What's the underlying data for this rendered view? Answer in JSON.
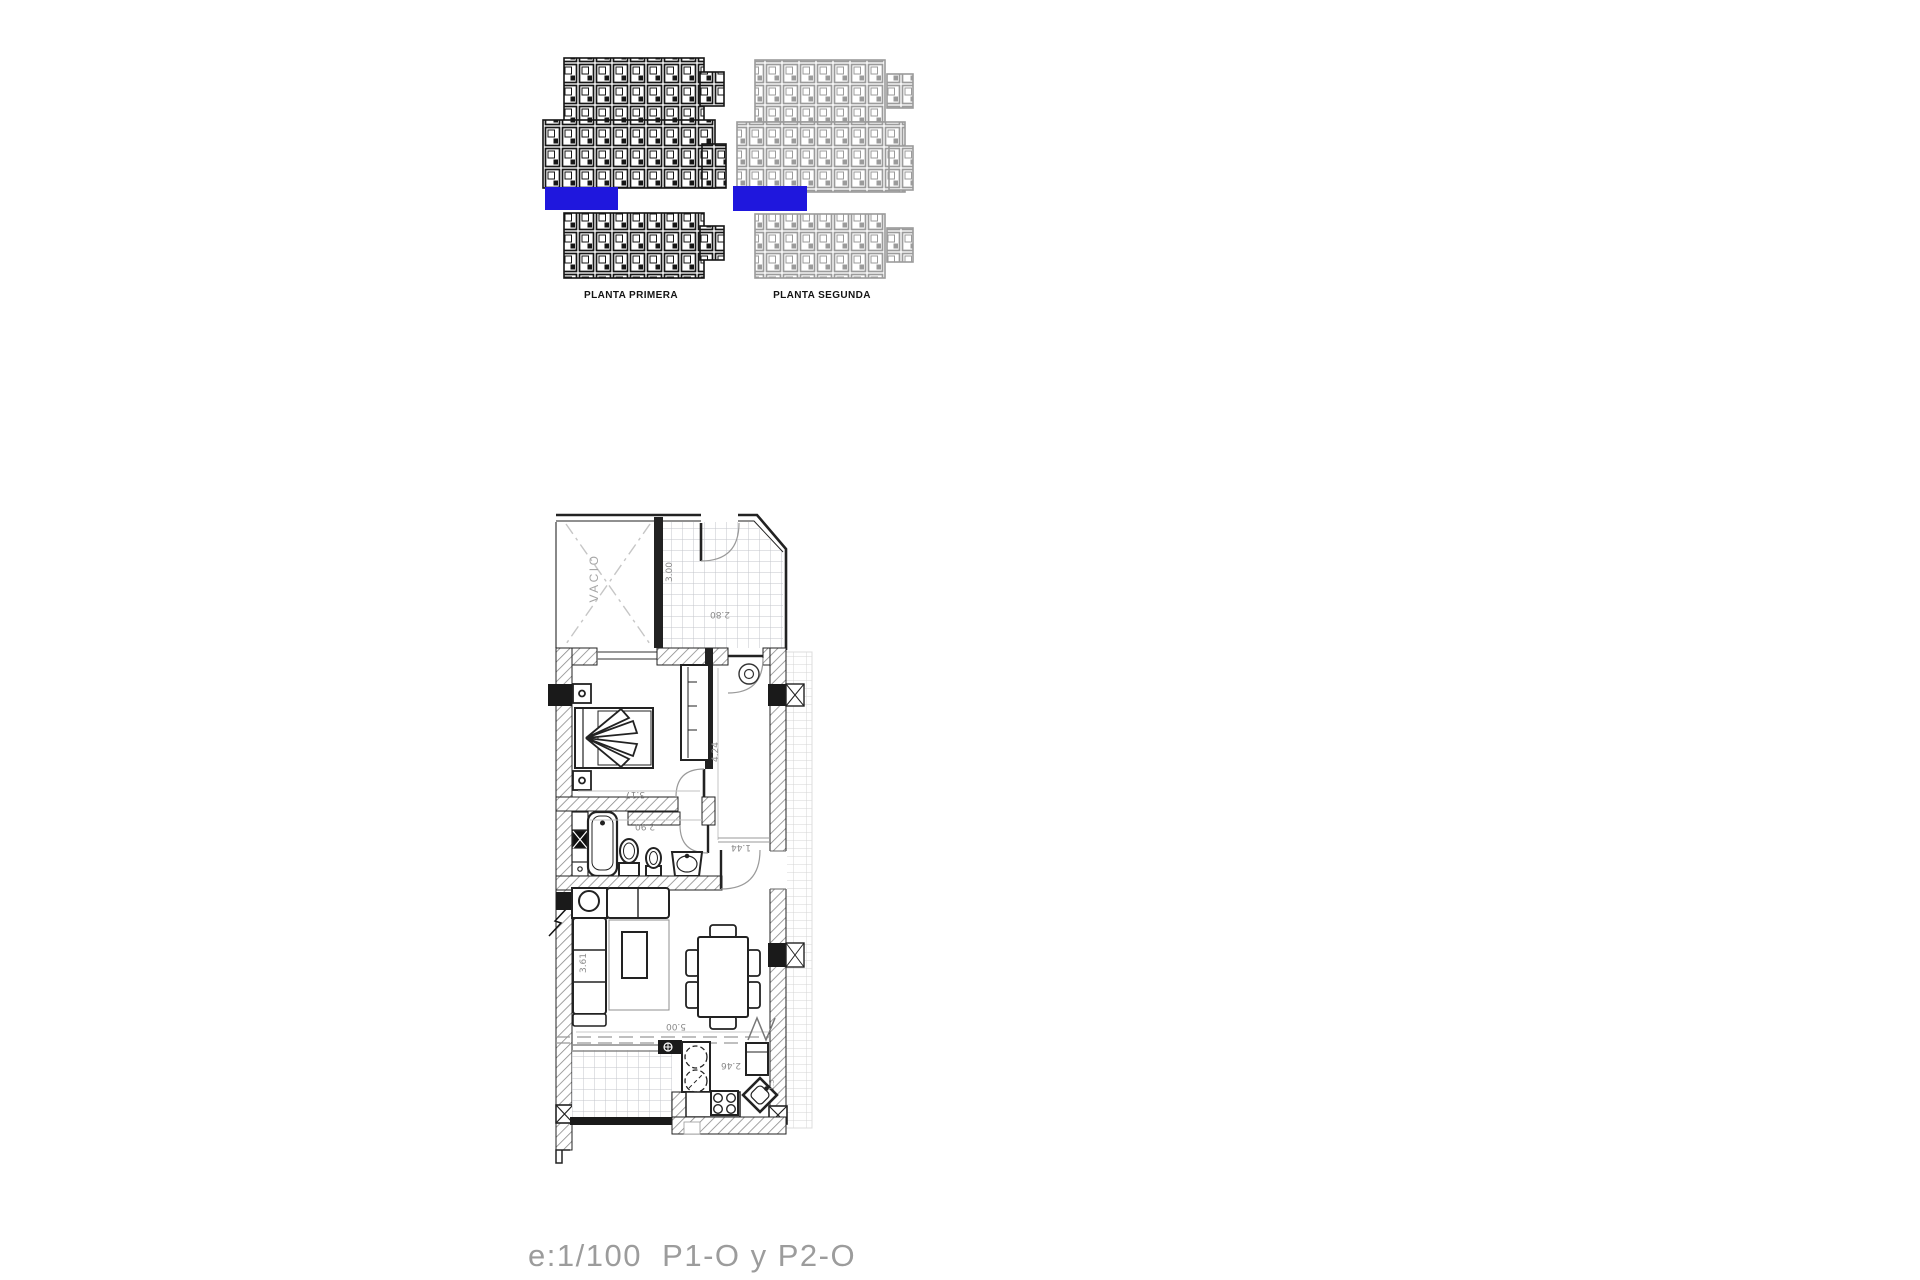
{
  "overview": {
    "planta_primera": {
      "label": "PLANTA PRIMERA"
    },
    "planta_segunda": {
      "label": "PLANTA SEGUNDA"
    },
    "highlight_color": "#1f17dd"
  },
  "floor_plan": {
    "labels": {
      "vacio": "VACIO"
    },
    "dimensions": {
      "terrace_depth": "3.00",
      "terrace_width": "2.80",
      "bedroom_width": "3.17",
      "hall_length": "4.24",
      "bathroom_width": "2.90",
      "entry_width": "1.44",
      "living_width": "5.00",
      "living_depth": "3.61",
      "kitchen_width": "2.46",
      "kitchen_side": "1.5"
    }
  },
  "footer": {
    "scale_label": "e:1/100  P1-O y P2-O"
  }
}
